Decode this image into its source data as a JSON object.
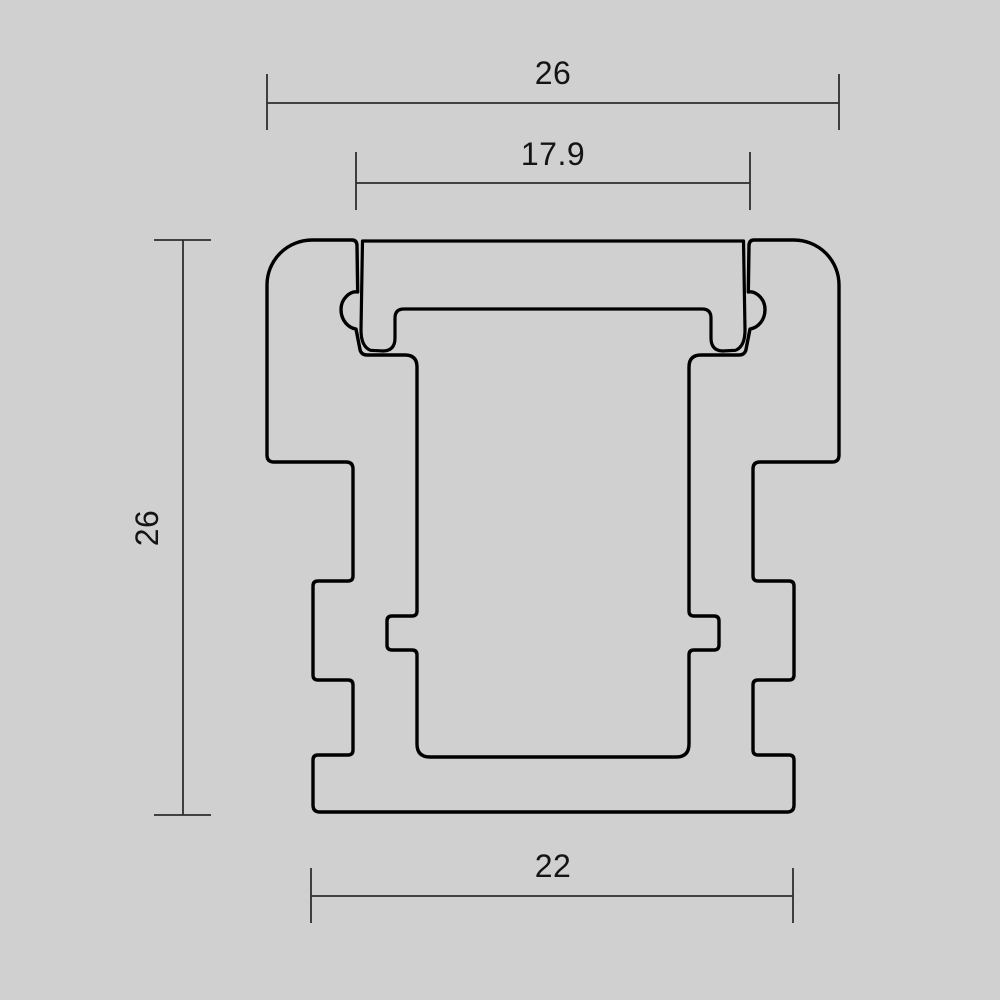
{
  "canvas": {
    "background": "#d0d0d0",
    "outline_color": "#000000",
    "dimension_color": "#2d2d2d",
    "text_color": "#141414"
  },
  "drawing": {
    "dimensions": [
      {
        "id": "overall-width",
        "label": "26",
        "orientation": "horizontal",
        "position": "top"
      },
      {
        "id": "opening-width",
        "label": "17.9",
        "orientation": "horizontal",
        "position": "top-inner"
      },
      {
        "id": "overall-height",
        "label": "26",
        "orientation": "vertical",
        "position": "left"
      },
      {
        "id": "base-width",
        "label": "22",
        "orientation": "horizontal",
        "position": "bottom"
      }
    ]
  }
}
